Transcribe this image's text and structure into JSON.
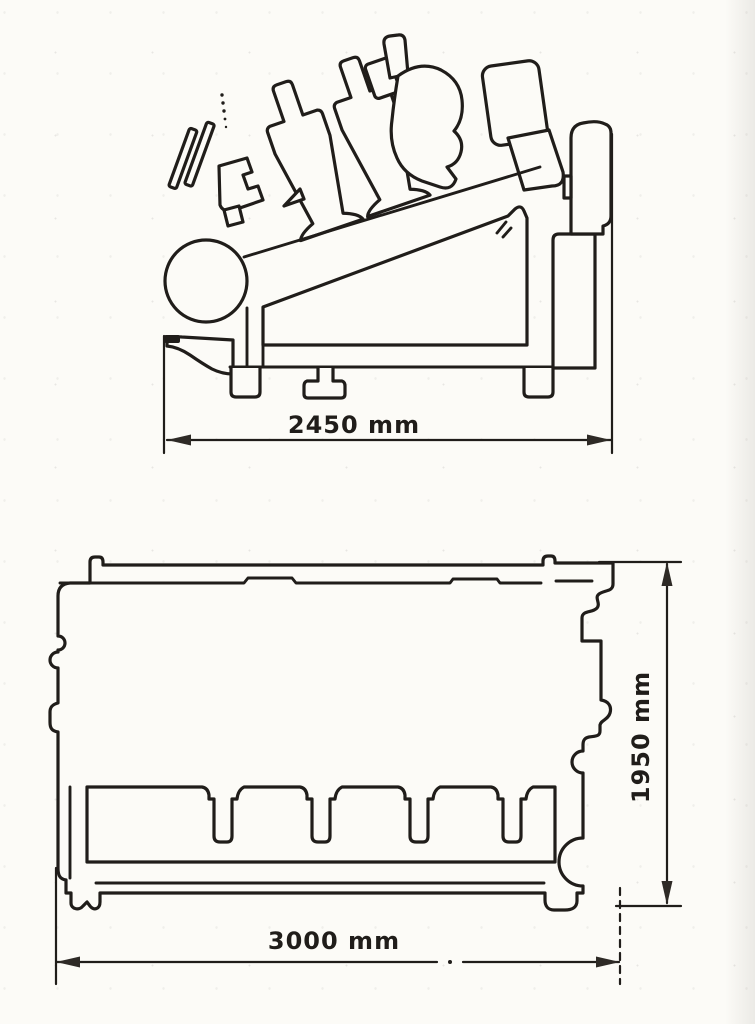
{
  "colors": {
    "paper": "#fcfbf7",
    "ink": "#201d1a",
    "arrow_fill": "#2e2a26"
  },
  "figure": {
    "top_view": {
      "width_label": "2450 mm"
    },
    "bottom_view": {
      "length_label": "3000 mm",
      "height_label": "1950 mm"
    }
  }
}
